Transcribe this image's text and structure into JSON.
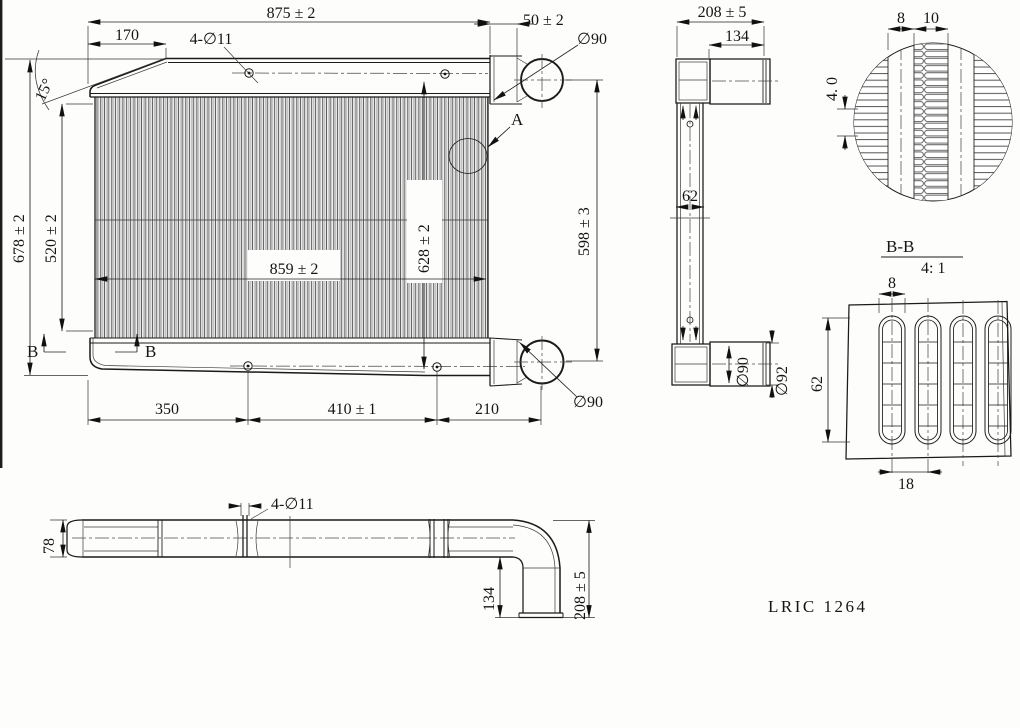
{
  "part_code": "LRIC 1264",
  "front_view": {
    "overall_width": "875 ± 2",
    "left_offset": "170",
    "holes_label": "4-∅11",
    "pipe_stub_len": "50 ± 2",
    "top_pipe_dia": "∅90",
    "corner_angle": "15°",
    "overall_height": "678 ± 2",
    "core_height": "520 ± 2",
    "core_width": "859 ± 2",
    "mid_height": "628 ± 2",
    "pipe_span": "598 ± 3",
    "detail_mark": "A",
    "section_mark_left": "B",
    "section_mark_right": "B",
    "hole_dist_left": "350",
    "hole_dist_mid": "410 ± 1",
    "hole_dist_right": "210",
    "bottom_pipe_dia": "∅90"
  },
  "side_view": {
    "depth": "208 ± 5",
    "pipe_length": "134",
    "core_thickness": "62",
    "pipe_inner_dia": "∅90",
    "pipe_outer_dia": "∅92"
  },
  "detail_a": {
    "tube_width": "8",
    "fin_width": "10",
    "fin_pitch": "4. 0"
  },
  "section_bb": {
    "title": "B-B",
    "scale": "4: 1",
    "tube_width": "8",
    "tube_depth": "62",
    "tube_pitch": "18"
  },
  "bottom_view": {
    "bar_height": "78",
    "holes_label": "4-∅11",
    "elbow_drop": "134",
    "total_drop": "208 ± 5"
  }
}
